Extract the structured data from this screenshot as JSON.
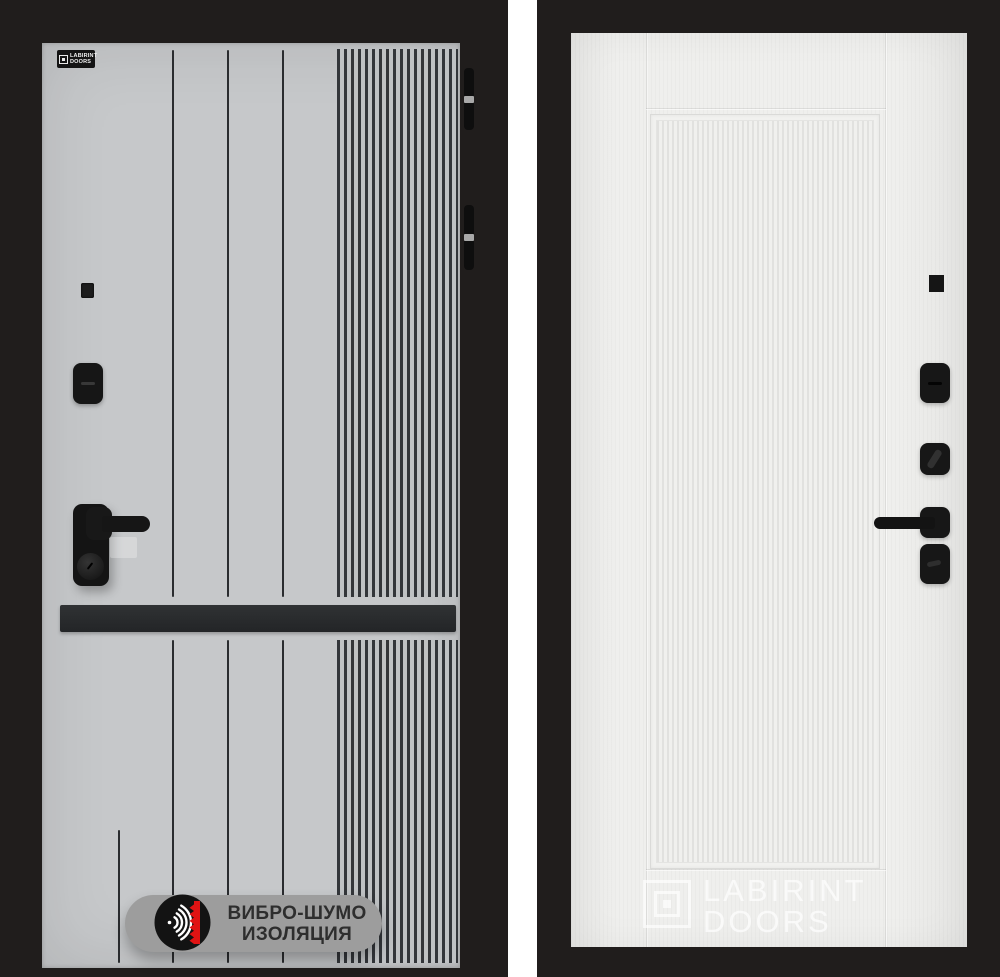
{
  "scene": {
    "description": "Product photo of two entry door leaves side by side",
    "background": "#ffffff"
  },
  "colors": {
    "frame": "#201d1c",
    "left_panel": "#c6c8ca",
    "left_stripe": "#2a2c2f",
    "rib_dark": "#33363a",
    "left_bar": "#232527",
    "hardware": "#1a1a1a",
    "right_panel": "#efefed",
    "rib_line": "#e1e1df",
    "badge_bg": "#9d9d9d",
    "badge_text": "#2e2e2e",
    "badge_accent": "#e01313"
  },
  "left_door": {
    "brand_plate": {
      "line1": "LABIRINT",
      "line2": "DOORS"
    },
    "badge": {
      "line1": "ВИБРО-ШУМО",
      "line2": "ИЗОЛЯЦИЯ"
    }
  },
  "right_door": {
    "watermark": {
      "line1": "LABIRINT",
      "line2": "DOORS"
    }
  }
}
